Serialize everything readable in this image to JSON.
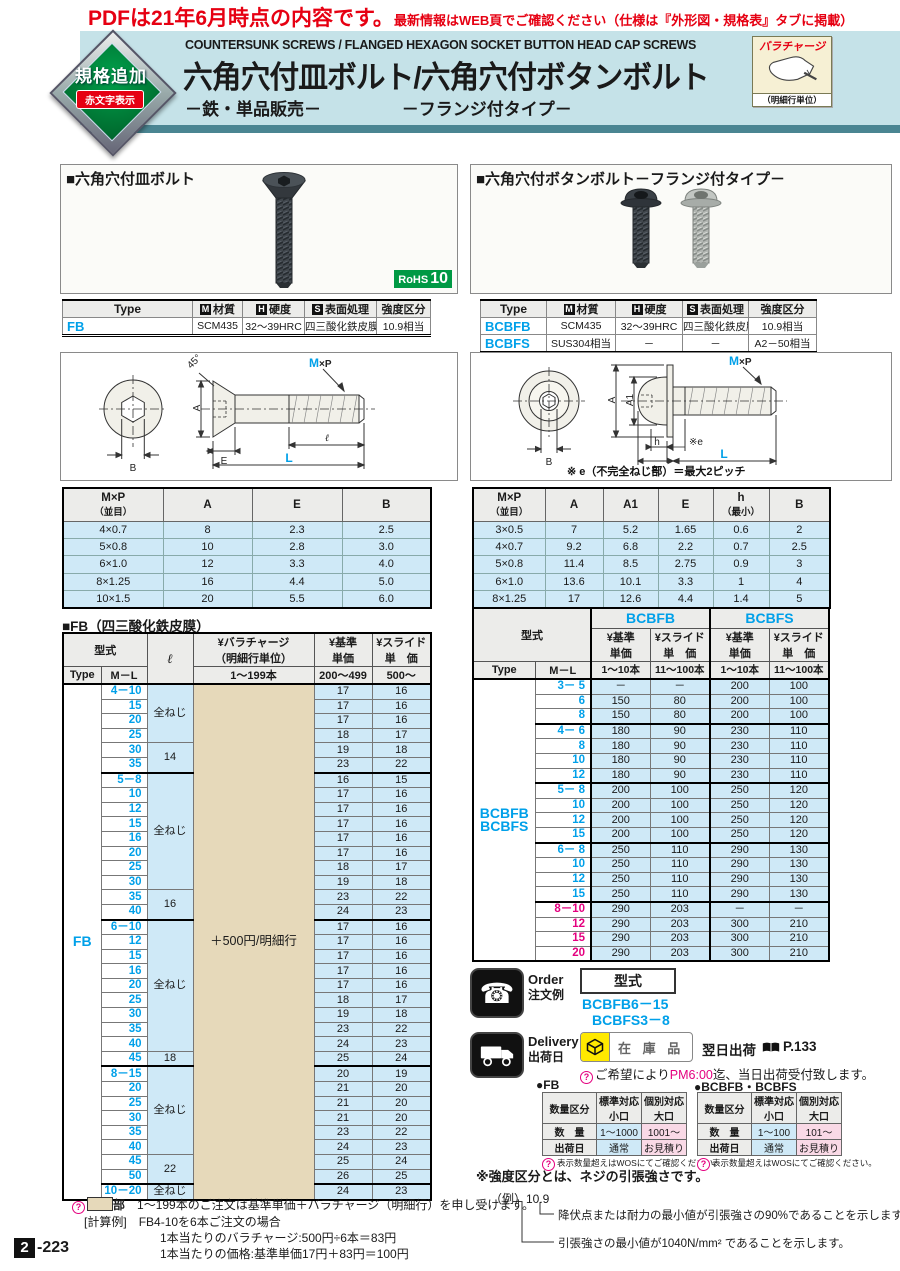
{
  "icons": {
    "m": "M",
    "h": "H",
    "s": "S",
    "q": "?",
    "phone": "☎"
  },
  "notice": {
    "main": "PDFは21年6月時点の内容です。",
    "sub": "最新情報はWEB頁でご確認ください（仕様は『外形図・規格表』タブに掲載）"
  },
  "header": {
    "badge_line1": "規格追加",
    "badge_line2": "赤文字表示",
    "title_en": "COUNTERSUNK SCREWS / FLANGED HEXAGON SOCKET BUTTON HEAD CAP SCREWS",
    "title_jp": "六角穴付皿ボルト/六角穴付ボタンボルト",
    "sub_left": "－鉄・単品販売－",
    "sub_right": "－フランジ付タイプ－",
    "paracharge": {
      "title": "バラチャージ",
      "unit": "（明細行単位）"
    }
  },
  "left": {
    "section_title": "■六角穴付皿ボルト",
    "rohs": {
      "label": "RoHS",
      "value": "10"
    },
    "spec": {
      "h_type": "Type",
      "h_mat": "材質",
      "h_hard": "硬度",
      "h_surf": "表面処理",
      "h_str": "強度区分",
      "rows": [
        [
          "FB",
          "SCM435",
          "32～39HRC",
          "四三酸化鉄皮膜",
          "10.9相当"
        ]
      ]
    },
    "drawing": {
      "mxp_m": "M",
      "mxp_p": "×P",
      "deg": "45°",
      "A": "A",
      "E": "E",
      "B": "B",
      "l": "ℓ",
      "L": "L"
    },
    "dim": {
      "h1a": "M×P",
      "h1b": "（並目）",
      "h2": "A",
      "h3": "E",
      "h4": "B",
      "rows": [
        [
          "4×0.7",
          "8",
          "2.3",
          "2.5"
        ],
        [
          "5×0.8",
          "10",
          "2.8",
          "3.0"
        ],
        [
          "6×1.0",
          "12",
          "3.3",
          "4.0"
        ],
        [
          "8×1.25",
          "16",
          "4.4",
          "5.0"
        ],
        [
          "10×1.5",
          "20",
          "5.5",
          "6.0"
        ]
      ]
    },
    "price_title": "■FB（四三酸化鉄皮膜）",
    "price": {
      "h_model": "型式",
      "h_type": "Type",
      "h_ml": "M－L",
      "h_l": "ℓ",
      "h_para1": "¥バラチャージ",
      "h_para2": "（明細行単位）",
      "h_para_sub": "1～199本",
      "h_base1": "¥基準",
      "h_base2": "単価",
      "h_base_sub": "200～499",
      "h_slide1": "¥スライド",
      "h_slide2": "単　価",
      "h_slide_sub": "500～",
      "type_label": "FB",
      "para_cell": "＋500円/明細行",
      "rows": [
        [
          "4－10",
          "全ねじ",
          4,
          "17",
          "16",
          1
        ],
        [
          "15",
          null,
          0,
          "17",
          "16",
          0
        ],
        [
          "20",
          null,
          0,
          "17",
          "16",
          0
        ],
        [
          "25",
          null,
          0,
          "18",
          "17",
          0
        ],
        [
          "30",
          "14",
          2,
          "19",
          "18",
          0
        ],
        [
          "35",
          null,
          0,
          "23",
          "22",
          0
        ],
        [
          "5－8",
          "全ねじ",
          8,
          "16",
          "15",
          1
        ],
        [
          "10",
          null,
          0,
          "17",
          "16",
          0
        ],
        [
          "12",
          null,
          0,
          "17",
          "16",
          0
        ],
        [
          "15",
          null,
          0,
          "17",
          "16",
          0
        ],
        [
          "16",
          null,
          0,
          "17",
          "16",
          0
        ],
        [
          "20",
          null,
          0,
          "17",
          "16",
          0
        ],
        [
          "25",
          null,
          0,
          "18",
          "17",
          0
        ],
        [
          "30",
          null,
          0,
          "19",
          "18",
          0
        ],
        [
          "35",
          "16",
          2,
          "23",
          "22",
          0
        ],
        [
          "40",
          null,
          0,
          "24",
          "23",
          0
        ],
        [
          "6－10",
          "全ねじ",
          9,
          "17",
          "16",
          1
        ],
        [
          "12",
          null,
          0,
          "17",
          "16",
          0
        ],
        [
          "15",
          null,
          0,
          "17",
          "16",
          0
        ],
        [
          "16",
          null,
          0,
          "17",
          "16",
          0
        ],
        [
          "20",
          null,
          0,
          "17",
          "16",
          0
        ],
        [
          "25",
          null,
          0,
          "18",
          "17",
          0
        ],
        [
          "30",
          null,
          0,
          "19",
          "18",
          0
        ],
        [
          "35",
          null,
          0,
          "23",
          "22",
          0
        ],
        [
          "40",
          null,
          0,
          "24",
          "23",
          0
        ],
        [
          "45",
          "18",
          1,
          "25",
          "24",
          0
        ],
        [
          "8－15",
          "全ねじ",
          6,
          "20",
          "19",
          1
        ],
        [
          "20",
          null,
          0,
          "21",
          "20",
          0
        ],
        [
          "25",
          null,
          0,
          "21",
          "20",
          0
        ],
        [
          "30",
          null,
          0,
          "21",
          "20",
          0
        ],
        [
          "35",
          null,
          0,
          "23",
          "22",
          0
        ],
        [
          "40",
          null,
          0,
          "24",
          "23",
          0
        ],
        [
          "45",
          "22",
          2,
          "25",
          "24",
          0
        ],
        [
          "50",
          null,
          0,
          "26",
          "25",
          0
        ],
        [
          "10－20",
          "全ねじ",
          1,
          "24",
          "23",
          1
        ]
      ]
    },
    "notes": {
      "n1a": "部",
      "n1b": "1～199本のご注文は基準単価＋バラチャージ（明細行）を申し受けます。",
      "n2_label": "[計算例]",
      "n2": "FB4-10を6本ご注文の場合",
      "n3": "1本当たりのバラチャージ:500円÷6本＝83円",
      "n4": "1本当たりの価格:基準単価17円＋83円＝100円"
    }
  },
  "right": {
    "section_title": "■六角穴付ボタンボルト－フランジ付タイプ－",
    "spec": {
      "h_type": "Type",
      "h_mat": "材質",
      "h_hard": "硬度",
      "h_surf": "表面処理",
      "h_str": "強度区分",
      "rows": [
        [
          "BCBFB",
          "SCM435",
          "32～39HRC",
          "四三酸化鉄皮膜",
          "10.9相当"
        ],
        [
          "BCBFS",
          "SUS304相当",
          "－",
          "－",
          "A2－50相当"
        ]
      ]
    },
    "drawing": {
      "mxp_m": "M",
      "mxp_p": "×P",
      "A": "A",
      "A1": "A1",
      "B": "B",
      "h": "h",
      "e": "※e",
      "E": "E",
      "L": "L",
      "note": "※ e（不完全ねじ部）＝最大2ピッチ"
    },
    "dim": {
      "h1a": "M×P",
      "h1b": "（並目）",
      "h2": "A",
      "h3": "A1",
      "h4": "E",
      "h5a": "h",
      "h5b": "（最小）",
      "h6": "B",
      "rows": [
        [
          "3×0.5",
          "7",
          "5.2",
          "1.65",
          "0.6",
          "2"
        ],
        [
          "4×0.7",
          "9.2",
          "6.8",
          "2.2",
          "0.7",
          "2.5"
        ],
        [
          "5×0.8",
          "11.4",
          "8.5",
          "2.75",
          "0.9",
          "3"
        ],
        [
          "6×1.0",
          "13.6",
          "10.1",
          "3.3",
          "1",
          "4"
        ],
        [
          "8×1.25",
          "17",
          "12.6",
          "4.4",
          "1.4",
          "5"
        ]
      ]
    },
    "price": {
      "h_model": "型式",
      "h_type": "Type",
      "h_ml": "M－L",
      "g1": "BCBFB",
      "g2": "BCBFS",
      "h_base1": "¥基準",
      "h_base2": "単価",
      "h_slide1": "¥スライド",
      "h_slide2": "単　価",
      "sub_base": "1～10本",
      "sub_slide": "11～100本",
      "type1": "BCBFB",
      "type2": "BCBFS",
      "rows": [
        [
          "3－ 5",
          "－",
          "－",
          "200",
          "100",
          1,
          0
        ],
        [
          "6",
          "150",
          "80",
          "200",
          "100",
          0,
          0
        ],
        [
          "8",
          "150",
          "80",
          "200",
          "100",
          0,
          0
        ],
        [
          "4－ 6",
          "180",
          "90",
          "230",
          "110",
          1,
          0
        ],
        [
          "8",
          "180",
          "90",
          "230",
          "110",
          0,
          0
        ],
        [
          "10",
          "180",
          "90",
          "230",
          "110",
          0,
          0
        ],
        [
          "12",
          "180",
          "90",
          "230",
          "110",
          0,
          0
        ],
        [
          "5－ 8",
          "200",
          "100",
          "250",
          "120",
          1,
          0
        ],
        [
          "10",
          "200",
          "100",
          "250",
          "120",
          0,
          0
        ],
        [
          "12",
          "200",
          "100",
          "250",
          "120",
          0,
          0
        ],
        [
          "15",
          "200",
          "100",
          "250",
          "120",
          0,
          0
        ],
        [
          "6－ 8",
          "250",
          "110",
          "290",
          "130",
          1,
          0
        ],
        [
          "10",
          "250",
          "110",
          "290",
          "130",
          0,
          0
        ],
        [
          "12",
          "250",
          "110",
          "290",
          "130",
          0,
          0
        ],
        [
          "15",
          "250",
          "110",
          "290",
          "130",
          0,
          0
        ],
        [
          "8－10",
          "290",
          "203",
          "－",
          "－",
          1,
          1
        ],
        [
          "12",
          "290",
          "203",
          "300",
          "210",
          0,
          1
        ],
        [
          "15",
          "290",
          "203",
          "300",
          "210",
          0,
          1
        ],
        [
          "20",
          "290",
          "203",
          "300",
          "210",
          0,
          1
        ]
      ]
    },
    "order": {
      "en": "Order",
      "jp": "注文例",
      "model": "型式",
      "ex1": "BCBFB6－15",
      "ex2": "BCBFS3－8"
    },
    "delivery": {
      "en": "Delivery",
      "jp": "出荷日",
      "stock": "在 庫 品",
      "ship": "翌日出荷",
      "page": "P.133",
      "note_pre": "ご希望により",
      "note_hl": "PM6:00",
      "note_post": "迄、当日出荷受付致します。"
    },
    "qty": [
      {
        "title": "●FB",
        "h1": "数量区分",
        "std1": "標準対応",
        "std2": "小口",
        "ind1": "個別対応",
        "ind2": "大口",
        "r1c1": "数　量",
        "r1c2": "1～1000",
        "r1c3": "1001～",
        "r2c1": "出荷日",
        "r2c2": "通常",
        "r2c3": "お見積り",
        "note": "表示数量超えはWOSにてご確認ください。"
      },
      {
        "title": "●BCBFB・BCBFS",
        "h1": "数量区分",
        "std1": "標準対応",
        "std2": "小口",
        "ind1": "個別対応",
        "ind2": "大口",
        "r1c1": "数　量",
        "r1c2": "1～100",
        "r1c3": "101～",
        "r2c1": "出荷日",
        "r2c2": "通常",
        "r2c3": "お見積り",
        "note": "表示数量超えはWOSにてご確認ください。"
      }
    ],
    "strength": {
      "t1": "※強度区分とは、ネジの引張強さです。",
      "ex": "（例）10.9",
      "n1": "降伏点または耐力の最小値が引張強さの90%であることを示します。",
      "n2": "引張強さの最小値が1040N/mm² であることを示します。"
    }
  },
  "page": {
    "num": "2",
    "rest": "-223"
  }
}
